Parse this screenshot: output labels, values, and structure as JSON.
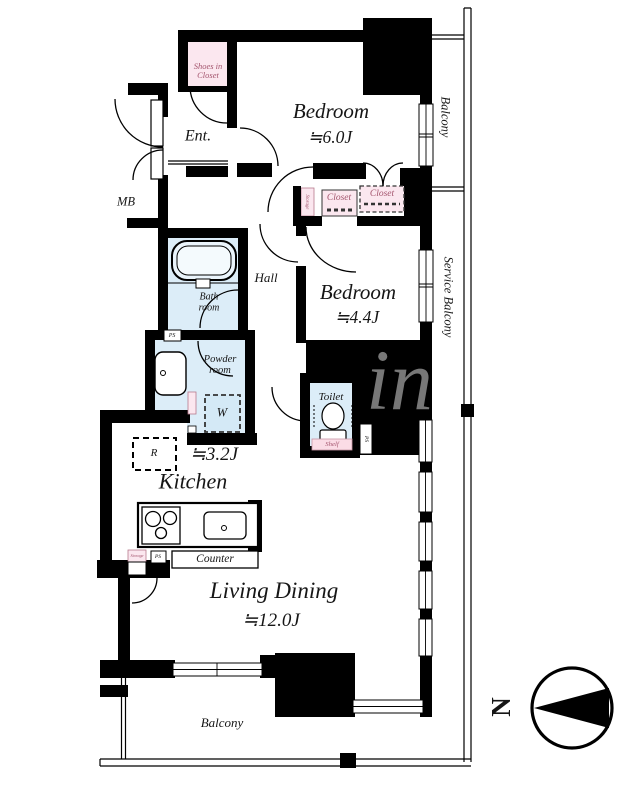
{
  "colors": {
    "wall": "#000000",
    "wet_area": "#dcedf8",
    "fixture_fill": "#eaf4fb",
    "closet_pink": "#fbe7ef",
    "shelf_pink": "#fbdce6",
    "closet_text": "#a4556e",
    "label_text": "#161616"
  },
  "labels": {
    "entrance": "Ent.",
    "shoes_closet_line1": "Shoes in",
    "shoes_closet_line2": "Closet",
    "bedroom1_name": "Bedroom",
    "bedroom1_size": "≒6.0J",
    "bedroom2_name": "Bedroom",
    "bedroom2_size": "≒4.4J",
    "balcony_side": "Balcony",
    "service_balcony": "Service Balcony",
    "balcony_bottom": "Balcony",
    "closet_left": "Closet",
    "closet_right": "Closet",
    "storage_hall": "Storage",
    "storage_kitchen": "Storage",
    "mb": "MB",
    "hall": "Hall",
    "bath_line1": "Bath",
    "bath_line2": "room",
    "powder_line1": "Powder",
    "powder_line2": "room",
    "toilet": "Toilet",
    "shelf": "Shelf",
    "washer": "W",
    "fridge": "R",
    "kitchen_name": "Kitchen",
    "kitchen_size": "≒3.2J",
    "counter": "Counter",
    "living_name": "Living Dining",
    "living_size": "≒12.0J",
    "ps_bath": "PS",
    "ps_toilet": "PS",
    "ps_kitchen": "PS",
    "compass_north": "N",
    "watermark": "in"
  }
}
